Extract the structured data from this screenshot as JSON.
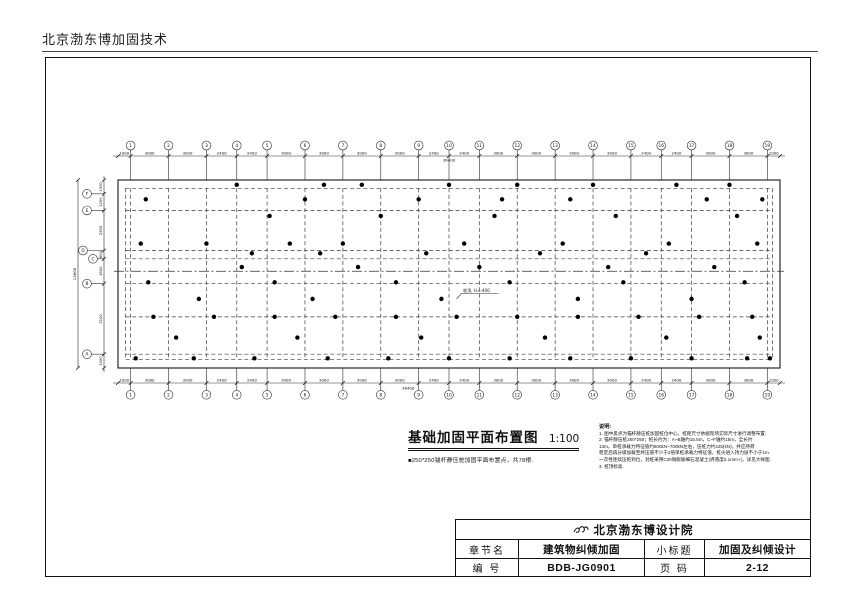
{
  "page": {
    "header": "北京渤东博加固技术"
  },
  "plan": {
    "title": "基础加固平面布置图",
    "scale": "1:100",
    "legend": "■250*250锚杆静压桩加固平面布置点，共78根.",
    "total_width_label": "36400",
    "total_height_label": "13600",
    "top_axes": [
      "1",
      "2",
      "3",
      "4",
      "5",
      "6",
      "7",
      "8",
      "9",
      "10",
      "11",
      "12",
      "13",
      "14",
      "15",
      "16",
      "17",
      "18",
      "19"
    ],
    "top_dims": [
      "1000",
      "3000",
      "3000",
      "2400",
      "2400",
      "3000",
      "3000",
      "3000",
      "3000",
      "2400",
      "2400",
      "3000",
      "3000",
      "3000",
      "3000",
      "2400",
      "2400",
      "3000",
      "3000",
      "1000"
    ],
    "left_axes": [
      "F",
      "E",
      "D",
      "C",
      "B",
      "A"
    ],
    "left_dims": [
      "1000",
      "1200",
      "2900",
      "600",
      "1800",
      "5100",
      "1000"
    ],
    "dashed_rows": [
      600,
      2200,
      5100,
      5700,
      7500,
      9900,
      12600,
      13000
    ],
    "centerline_row": 6600,
    "leader": {
      "text": "桩顶, H=-400",
      "target": [
        26800,
        8600
      ]
    },
    "piles": [
      [
        9400,
        350
      ],
      [
        16300,
        350
      ],
      [
        19300,
        350
      ],
      [
        26200,
        350
      ],
      [
        31600,
        350
      ],
      [
        37600,
        350
      ],
      [
        44200,
        350
      ],
      [
        48400,
        350
      ],
      [
        2200,
        1400
      ],
      [
        14800,
        1400
      ],
      [
        23800,
        1400
      ],
      [
        30400,
        1400
      ],
      [
        35800,
        1400
      ],
      [
        46600,
        1400
      ],
      [
        51000,
        1400
      ],
      [
        12000,
        2600
      ],
      [
        20800,
        2600
      ],
      [
        29800,
        2600
      ],
      [
        39400,
        2600
      ],
      [
        49000,
        2600
      ],
      [
        1800,
        4600
      ],
      [
        7000,
        4600
      ],
      [
        13600,
        4600
      ],
      [
        17800,
        4600
      ],
      [
        27400,
        4600
      ],
      [
        35200,
        4600
      ],
      [
        43600,
        4600
      ],
      [
        50600,
        4600
      ],
      [
        10600,
        5300
      ],
      [
        16000,
        5300
      ],
      [
        24400,
        5300
      ],
      [
        33400,
        5300
      ],
      [
        41800,
        5300
      ],
      [
        9800,
        6300
      ],
      [
        19000,
        6300
      ],
      [
        28600,
        6300
      ],
      [
        38800,
        6300
      ],
      [
        47200,
        6300
      ],
      [
        2400,
        7400
      ],
      [
        12400,
        7400
      ],
      [
        22000,
        7400
      ],
      [
        31000,
        7400
      ],
      [
        40000,
        7400
      ],
      [
        49600,
        7400
      ],
      [
        6400,
        8600
      ],
      [
        15400,
        8600
      ],
      [
        25600,
        8600
      ],
      [
        36400,
        8600
      ],
      [
        45400,
        8600
      ],
      [
        2800,
        9900
      ],
      [
        7600,
        9900
      ],
      [
        12400,
        9900
      ],
      [
        17200,
        9900
      ],
      [
        22000,
        9900
      ],
      [
        26800,
        9900
      ],
      [
        31600,
        9900
      ],
      [
        36400,
        9900
      ],
      [
        41200,
        9900
      ],
      [
        46000,
        9900
      ],
      [
        50200,
        9900
      ],
      [
        4600,
        11400
      ],
      [
        14200,
        11400
      ],
      [
        24000,
        11400
      ],
      [
        33800,
        11400
      ],
      [
        43400,
        11400
      ],
      [
        50800,
        11400
      ],
      [
        1400,
        12900
      ],
      [
        6000,
        12900
      ],
      [
        10800,
        12900
      ],
      [
        16600,
        12900
      ],
      [
        21400,
        12900
      ],
      [
        26200,
        12900
      ],
      [
        31000,
        12900
      ],
      [
        35800,
        12900
      ],
      [
        40600,
        12900
      ],
      [
        45400,
        12900
      ],
      [
        49800,
        12900
      ],
      [
        51600,
        12900
      ]
    ]
  },
  "notes": {
    "title": "说明:",
    "lines": [
      "1. 图中黑点为锚杆静压桩加固桩位中心，桩距尺寸依据现场实际尺寸进行调整布置.",
      "2. 锚杆静压桩250*250；桩长约为：A~B轴约15.5m，C~F轴约15m，全长约",
      "13m。单桩承载力特征值约600kN~700kN左右，压桩力约425(kN)，并应持荷",
      "稳定后再分级加载至终压值不少于2倍单桩承载力特征值，桩尖进入持力层不小于1m.",
      "一次性连续压桩到位，封桩采用C30微膨胀细石混凝土(坍落度0.1mm+)，详见大样图.",
      "3. 桩顶标高."
    ]
  },
  "titleblock": {
    "company": "北京渤东博设计院",
    "rows": [
      {
        "k1": "章节名",
        "v1": "建筑物纠倾加固",
        "k2": "小标题",
        "v2": "加固及纠倾设计"
      },
      {
        "k1": "编  号",
        "v1": "BDB-JG0901",
        "k2": "页  码",
        "v2": "2-12"
      }
    ]
  }
}
